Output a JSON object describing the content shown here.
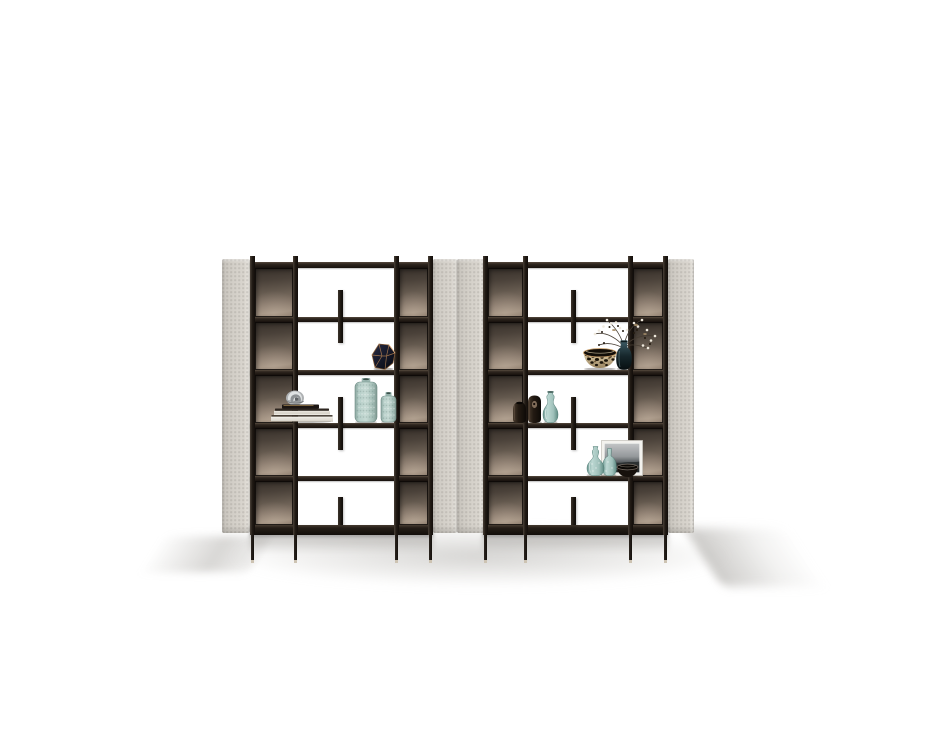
{
  "scene": {
    "description": "Studio product photo on a white background: a pair of tall open bookshelf room-divider units with pale greige upholstered side panels, smoked bronze back inserts, slim dark metal frames and thin legs, styled with vases, books, bowls, a framed print and dried branches",
    "background": "#ffffff",
    "palette": {
      "frame_dark": "#17110d",
      "frame_mid": "#2e261f",
      "frame_light": "#564a3e",
      "panel_base": "#d4d0c9",
      "panel_highlight": "#e9e6e0",
      "panel_shadow": "#bab6af",
      "bronze_dark": "#37302a",
      "bronze_mid": "#655a4f",
      "bronze_light": "#9c8c7c",
      "teal_light": "#bdd8d3",
      "teal_mid": "#8fb5ae",
      "teal_dark": "#5d8981",
      "copper": "#c08a55",
      "navy_vase": "#1a1d2b",
      "book_page": "#f1efe9",
      "chrome": "#d9dcdd",
      "leopard_base": "#d7c49c",
      "leopard_spot": "#1a1309",
      "espresso": "#241b14",
      "floor_shadow": "#b0aeaa"
    },
    "frame_y": {
      "stub_top": 256,
      "rail": {
        "y": 262,
        "h": 6
      },
      "shelves": [
        {
          "y": 317,
          "h": 5
        },
        {
          "y": 370,
          "h": 5
        },
        {
          "y": 423,
          "h": 5
        },
        {
          "y": 476,
          "h": 5
        }
      ],
      "bottom_slab": {
        "y": 525,
        "h": 10
      },
      "panel_top": 259,
      "panel_bottom": 533,
      "post_top": 256,
      "post_bottom": 535,
      "leg_top": 535,
      "leg_bottom": 563,
      "foot_h": 3
    },
    "units": [
      {
        "name": "bookshelf-left",
        "panels": [
          {
            "x": 222,
            "w": 28
          },
          {
            "x": 433,
            "w": 24
          }
        ],
        "carcass": {
          "x": 250,
          "w": 183
        },
        "posts": [
          250,
          293,
          394,
          428
        ],
        "post_w": 5,
        "bays": [
          {
            "x": 255,
            "w": 38
          },
          {
            "x": 399,
            "w": 29
          }
        ],
        "tab_w": 5,
        "tabs": [
          {
            "x": 338,
            "y": 290,
            "h": 53
          },
          {
            "x": 338,
            "y": 397,
            "h": 53
          },
          {
            "x": 338,
            "y": 497,
            "h": 28
          }
        ]
      },
      {
        "name": "bookshelf-right",
        "panels": [
          {
            "x": 457,
            "w": 27
          },
          {
            "x": 668,
            "w": 26
          }
        ],
        "carcass": {
          "x": 483,
          "w": 185
        },
        "posts": [
          483,
          523,
          628,
          663
        ],
        "post_w": 5,
        "bays": [
          {
            "x": 488,
            "w": 35
          },
          {
            "x": 633,
            "w": 30
          }
        ],
        "tab_w": 5,
        "tabs": [
          {
            "x": 571,
            "y": 290,
            "h": 53
          },
          {
            "x": 571,
            "y": 397,
            "h": 53
          },
          {
            "x": 571,
            "y": 497,
            "h": 28
          }
        ]
      }
    ],
    "items": [
      {
        "kind": "faceted-vase",
        "label": "faceted navy vase with copper edges",
        "x": 371,
        "y": 343,
        "w": 25,
        "h": 27
      },
      {
        "kind": "book-stack",
        "label": "stack of books with chrome sculpture",
        "x": 270,
        "y": 388,
        "w": 64,
        "h": 35
      },
      {
        "kind": "texture-vase-tall",
        "label": "tall textured aqua vase",
        "x": 354,
        "y": 378,
        "w": 24,
        "h": 45
      },
      {
        "kind": "texture-vase-short",
        "label": "short textured aqua vase",
        "x": 380,
        "y": 392,
        "w": 17,
        "h": 31
      },
      {
        "kind": "leopard-bowl",
        "label": "speckled tortoise bowl",
        "x": 582,
        "y": 347,
        "w": 36,
        "h": 23
      },
      {
        "kind": "branch-vase",
        "label": "dark bottle vase with dried blossom branches",
        "x": 590,
        "y": 317,
        "w": 68,
        "h": 53
      },
      {
        "kind": "dark-vase-pair",
        "label": "two espresso ceramic vases",
        "x": 511,
        "y": 395,
        "w": 32,
        "h": 28
      },
      {
        "kind": "gourd-vase",
        "label": "aqua glass gourd vase",
        "x": 542,
        "y": 391,
        "w": 17,
        "h": 32
      },
      {
        "kind": "art-frame",
        "label": "leaning grayscale art print",
        "x": 601,
        "y": 440,
        "w": 42,
        "h": 36
      },
      {
        "kind": "teal-pair",
        "label": "two aqua glass vases",
        "x": 585,
        "y": 444,
        "w": 33,
        "h": 32
      },
      {
        "kind": "dark-bowl",
        "label": "low black bowl",
        "x": 616,
        "y": 463,
        "w": 23,
        "h": 15
      }
    ]
  }
}
